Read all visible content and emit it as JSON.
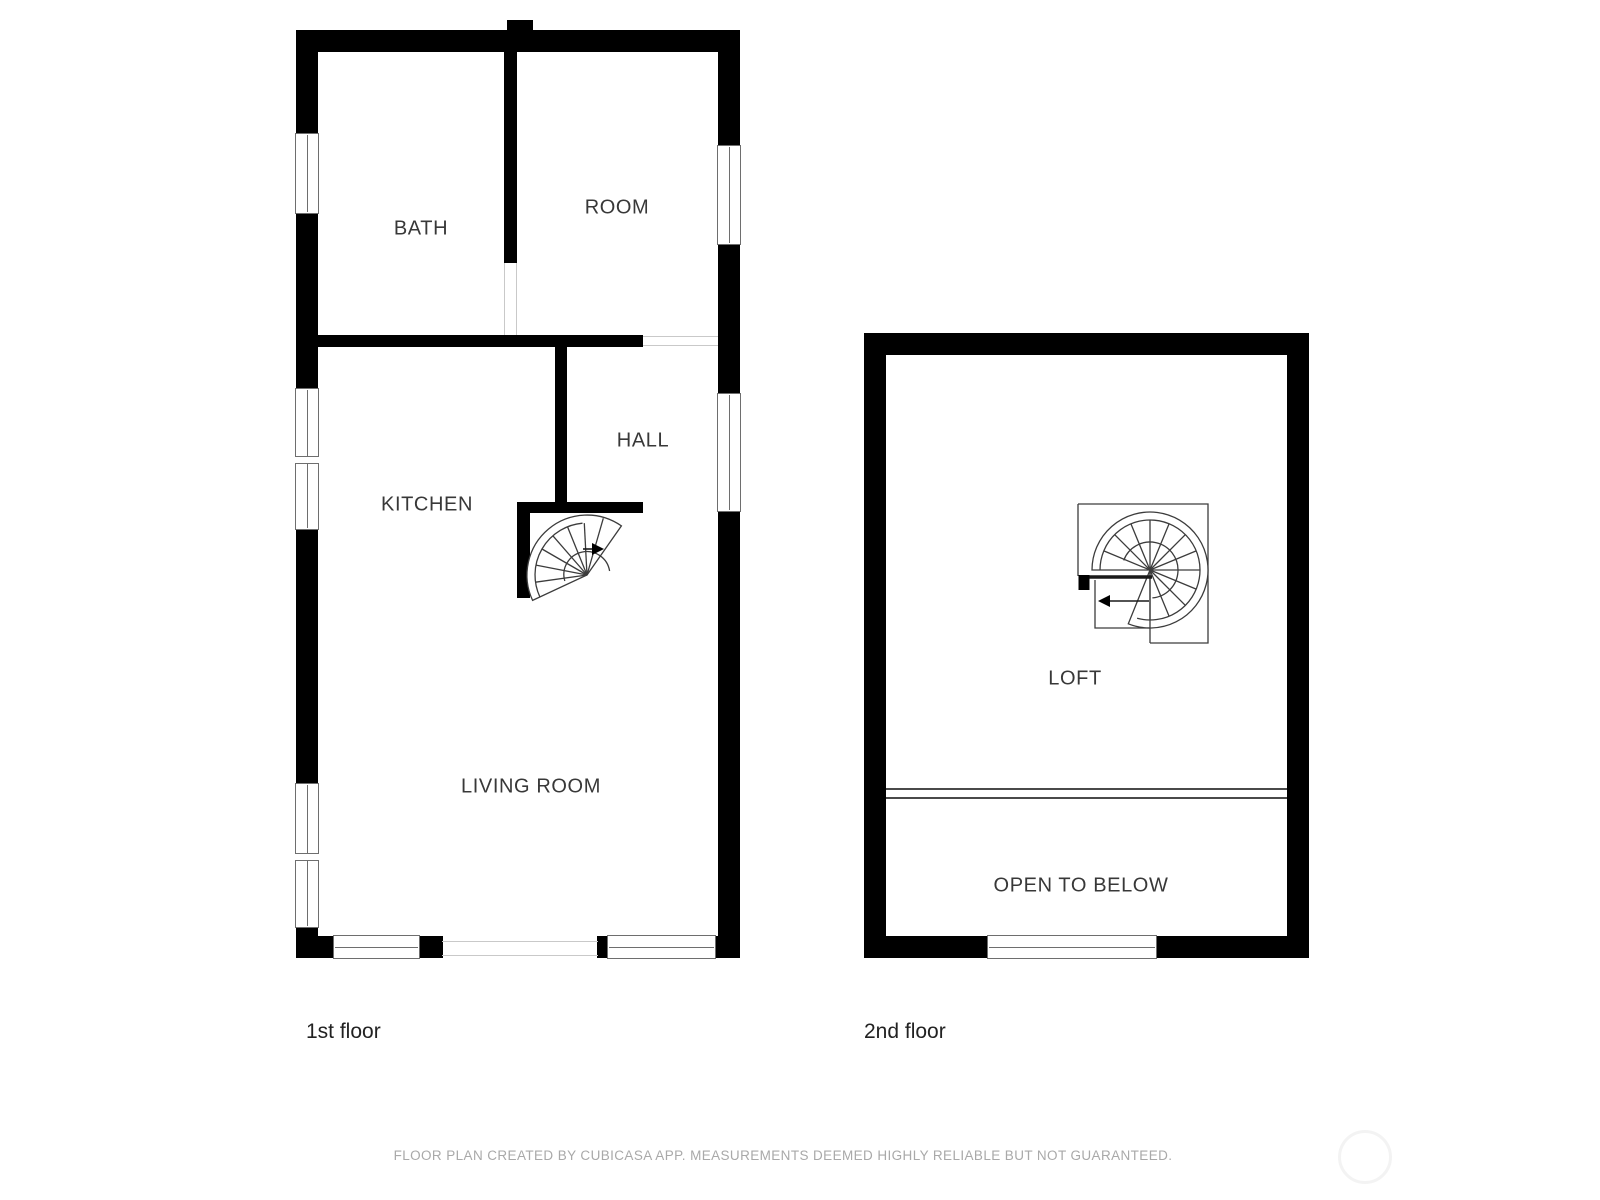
{
  "plan1": {
    "title": "1st floor",
    "labels": {
      "bath": "BATH",
      "room": "ROOM",
      "kitchen": "KITCHEN",
      "hall": "HALL",
      "living_room": "LIVING ROOM"
    }
  },
  "plan2": {
    "title": "2nd floor",
    "labels": {
      "loft": "LOFT",
      "open_to_below": "OPEN TO BELOW"
    }
  },
  "footer": {
    "disclaimer": "FLOOR PLAN CREATED BY CUBICASA APP. MEASUREMENTS DEEMED HIGHLY RELIABLE BUT NOT GUARANTEED."
  },
  "icons": {
    "stairs_first_floor": "spiral-staircase",
    "stairs_second_floor": "spiral-staircase",
    "stair_direction_first": "arrow-right",
    "stair_direction_second": "arrow-left",
    "watermark": "faint-circle"
  },
  "colors": {
    "background": "#ffffff",
    "wall": "#000000",
    "window_frame_line": "#6e6e6e",
    "opening_line": "#c9c9c9",
    "loft_edge_line": "#4a4a4a",
    "room_label": "#383838",
    "floor_title": "#222222",
    "footer_text": "#a9a9a9",
    "watermark": "#f3f3f3"
  }
}
